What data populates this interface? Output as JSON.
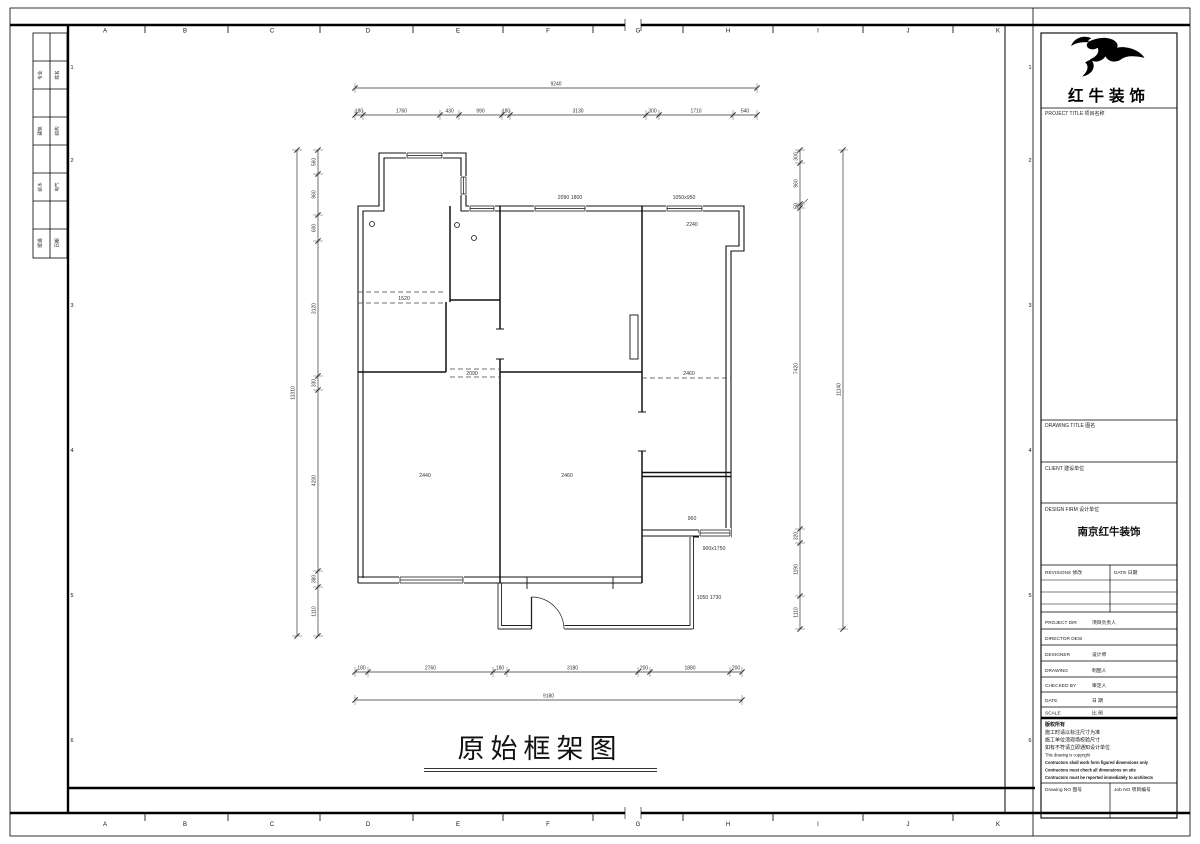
{
  "sheet": {
    "title": "原始框架图",
    "grid_letters": [
      "A",
      "B",
      "C",
      "D",
      "E",
      "F",
      "G",
      "H",
      "I",
      "J",
      "K"
    ],
    "grid_numbers": [
      "1",
      "2",
      "3",
      "4",
      "5",
      "6"
    ],
    "signature_rows": [
      [
        "专业",
        "姓名"
      ],
      [
        "建筑",
        "结构"
      ],
      [
        "给水",
        "电气"
      ],
      [
        "暖通",
        "日期"
      ]
    ]
  },
  "plan": {
    "dims_top_total": [
      "9240"
    ],
    "dims_top": [
      "180",
      "1760",
      "430",
      "990",
      "180",
      "3130",
      "300",
      "1710",
      "540"
    ],
    "dims_bottom": [
      "180",
      "2760",
      "180",
      "3180",
      "200",
      "1880",
      "200"
    ],
    "dims_bottom_total": [
      "9180"
    ],
    "dims_left": [
      "560",
      "960",
      "600",
      "3120",
      "330",
      "4200",
      "380",
      "1110"
    ],
    "dims_left_total": [
      "11310"
    ],
    "dims_right": [
      "300",
      "960",
      "50",
      "7420",
      "320",
      "1190",
      "1110"
    ],
    "dims_right_total": [
      "11140"
    ],
    "labels": [
      {
        "t": "2090 1800",
        "x": 570,
        "y": 199
      },
      {
        "t": "1050x950",
        "x": 684,
        "y": 199
      },
      {
        "t": "2240",
        "x": 692,
        "y": 226
      },
      {
        "t": "1520",
        "x": 404,
        "y": 300
      },
      {
        "t": "2090",
        "x": 472,
        "y": 375
      },
      {
        "t": "2460",
        "x": 689,
        "y": 375
      },
      {
        "t": "2440",
        "x": 425,
        "y": 477
      },
      {
        "t": "2460",
        "x": 567,
        "y": 477
      },
      {
        "t": "960",
        "x": 692,
        "y": 520
      },
      {
        "t": "900x1750",
        "x": 714,
        "y": 550
      },
      {
        "t": "1050 1730",
        "x": 709,
        "y": 599
      }
    ]
  },
  "title_block": {
    "logo_text": "红牛装饰",
    "project_title_label": "PROJECT TITLE  项目名称",
    "drawing_title_label": "DRAWING TITLE  图名",
    "client_label": "CLIENT  建设单位",
    "design_firm_label": "DESIGN FIRM  设计单位",
    "design_firm_value": "南京红牛装饰",
    "revisions_label": "REVISIONS  修改",
    "date_col_label": "DATE  日期",
    "staff_rows": [
      {
        "en": "PROJECT DIR",
        "cn": "项目负责人"
      },
      {
        "en": "DIRECTOR DESI",
        "cn": ""
      },
      {
        "en": "DESIGNER",
        "cn": "设计师"
      },
      {
        "en": "DRAWING",
        "cn": "制图人"
      },
      {
        "en": "CHECKED BY",
        "cn": "审定人"
      },
      {
        "en": "DATE",
        "cn": "日  期"
      },
      {
        "en": "SCALE",
        "cn": "比  例"
      }
    ],
    "notes": [
      "版权所有",
      "施工时请以标注尺寸为准",
      "施工单位须现场校验尺寸",
      "如有不符请立即通知设计单位",
      "This drawing is copyright",
      "Contractors shall work form figured dimensions only",
      "Contractors must check all dimensions on site",
      "Contractors must be reported immediately to architects"
    ],
    "drawing_no_label": "Drawing NO  图号",
    "job_no_label": "Job NO  项目编号"
  }
}
